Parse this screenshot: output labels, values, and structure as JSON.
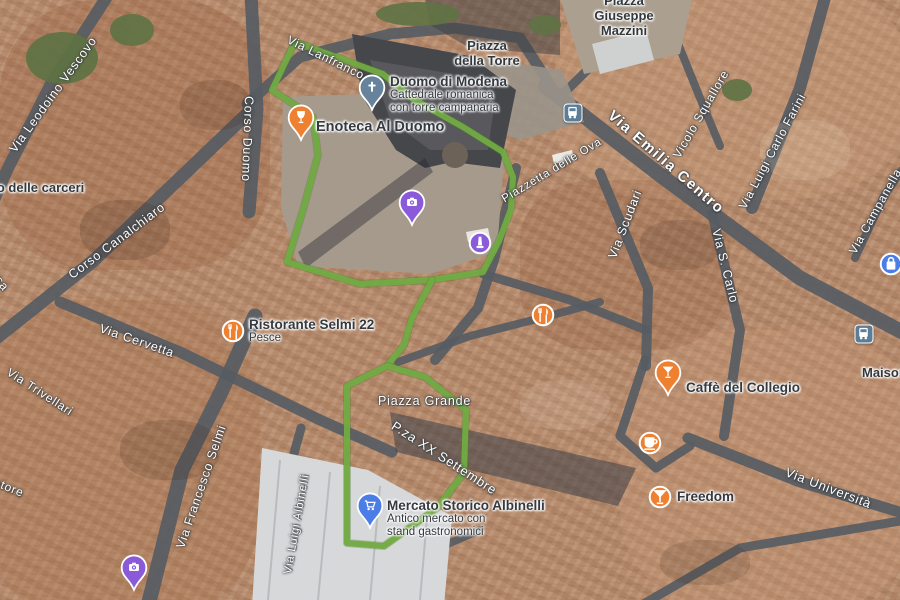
{
  "map": {
    "kind": "satellite-route-map",
    "route_color": "#72ab43",
    "poi_orange": "#ef8030",
    "poi_purple": "#8a5ad8",
    "poi_blue": "#4a7de8",
    "poi_church": "#66839b",
    "transit_color": "#5d7d96"
  },
  "route": {
    "outer_loop": "295,42 272,90 313,117 318,155 303,210 287,262 360,284 432,280 483,272 499,241 511,209 513,177 503,152 463,127 413,99 383,74 295,42",
    "connector": "432,280 412,318 404,345 387,366",
    "inner_loop": "387,366 347,386 347,543 384,546 437,508 464,473 466,410 425,377 387,366"
  },
  "pois": [
    {
      "id": "duomo-di-modena",
      "title": "Duomo di Modena",
      "subtitle_lines": [
        "Cattedrale romanica",
        "con torre campanaria"
      ],
      "marker": "pin",
      "icon": "church",
      "color": "#66839b",
      "x": 372,
      "y": 96,
      "label": {
        "x": 390,
        "y": 74,
        "align": "left",
        "size": 13.5
      }
    },
    {
      "id": "enoteca-al-duomo",
      "title": "Enoteca Al Duomo",
      "subtitle_lines": [],
      "marker": "pin",
      "icon": "wine",
      "color": "#ef8030",
      "x": 301,
      "y": 126,
      "label": {
        "x": 316,
        "y": 120,
        "align": "left",
        "size": 14.5
      }
    },
    {
      "id": "piazza-grande",
      "title": "Piazza Grande",
      "subtitle_lines": [],
      "marker": "pin",
      "icon": "camera",
      "color": "#8a5ad8",
      "x": 412,
      "y": 211,
      "label": {
        "x": 396,
        "y": 209,
        "align": "right",
        "size": 14.5
      }
    },
    {
      "id": "monument-poi",
      "title": "",
      "subtitle_lines": [],
      "marker": "dot",
      "icon": "monument",
      "color": "#8a5ad8",
      "x": 480,
      "y": 243
    },
    {
      "id": "mana",
      "title": "Manà",
      "subtitle_lines": [],
      "marker": "dot",
      "icon": "restaurant",
      "color": "#ef8030",
      "x": 543,
      "y": 315,
      "label": {
        "x": 527,
        "y": 307,
        "align": "right",
        "size": 13.5
      }
    },
    {
      "id": "ristorante-selmi-22",
      "title": "Ristorante Selmi 22",
      "subtitle_lines": [
        "Pesce"
      ],
      "marker": "dot",
      "icon": "restaurant",
      "color": "#ef8030",
      "x": 233,
      "y": 331,
      "label": {
        "x": 249,
        "y": 317,
        "align": "left",
        "size": 13.5
      }
    },
    {
      "id": "caffe-del-collegio",
      "title": "Caffè del Collegio",
      "subtitle_lines": [],
      "marker": "pin",
      "icon": "cocktail",
      "color": "#ef8030",
      "x": 668,
      "y": 381,
      "label": {
        "x": 686,
        "y": 380,
        "align": "left",
        "size": 13.5
      }
    },
    {
      "id": "canalino-caffe",
      "title": "Canalino Caffè",
      "subtitle_lines": [],
      "marker": "dot",
      "icon": "coffee",
      "color": "#ef8030",
      "x": 650,
      "y": 443,
      "label": {
        "x": 634,
        "y": 436,
        "align": "right",
        "size": 13.5
      }
    },
    {
      "id": "freedom",
      "title": "Freedom",
      "subtitle_lines": [],
      "marker": "dot",
      "icon": "cocktail",
      "color": "#ef8030",
      "x": 660,
      "y": 497,
      "label": {
        "x": 677,
        "y": 489,
        "align": "left",
        "size": 13.5
      }
    },
    {
      "id": "zara",
      "title": "Zara",
      "subtitle_lines": [
        "Negozio di abbigliamento"
      ],
      "marker": "dot",
      "icon": "bag",
      "color": "#4a7de8",
      "x": 891,
      "y": 264,
      "label": {
        "x": 877,
        "y": 249,
        "align": "right",
        "size": 14.5
      }
    },
    {
      "id": "mercato-storico-albinelli",
      "title": "Mercato Storico Albinelli",
      "subtitle_lines": [
        "Antico mercato con",
        "stand gastronomici"
      ],
      "marker": "pin",
      "icon": "cart",
      "color": "#4a7de8",
      "x": 370,
      "y": 514,
      "label": {
        "x": 387,
        "y": 498,
        "align": "left",
        "size": 13.5
      }
    },
    {
      "id": "storico-di-modena",
      "title": "Storico di Modena",
      "subtitle_lines": [],
      "marker": "pin",
      "icon": "camera",
      "color": "#8a5ad8",
      "x": 134,
      "y": 576,
      "label": {
        "x": 118,
        "y": 570,
        "align": "right",
        "size": 13.5
      }
    }
  ],
  "street_labels": [
    {
      "text": "Via Lanfranco",
      "x": 288,
      "y": 38,
      "rot": 26,
      "size": 12
    },
    {
      "text": "Via Leodoino Vescovo",
      "x": 12,
      "y": 150,
      "rot": -54,
      "size": 12.5
    },
    {
      "text": "Corso Duomo",
      "x": 249,
      "y": 95,
      "rot": 92,
      "size": 12.5
    },
    {
      "text": "corsa",
      "x": -14,
      "y": 262,
      "rot": 52,
      "size": 12
    },
    {
      "text": "Corso Canalchiaro",
      "x": 70,
      "y": 275,
      "rot": -37,
      "size": 12.5
    },
    {
      "text": "Via Cervetta",
      "x": 100,
      "y": 327,
      "rot": 19,
      "size": 12.5
    },
    {
      "text": "Via Trivellari",
      "x": 8,
      "y": 370,
      "rot": 33,
      "size": 12
    },
    {
      "text": "vatore",
      "x": -12,
      "y": 478,
      "rot": 22,
      "size": 12
    },
    {
      "text": "Via Francesco Selmi",
      "x": 180,
      "y": 547,
      "rot": -71,
      "size": 12.5
    },
    {
      "text": "Via Luigi Albinelli",
      "x": 288,
      "y": 574,
      "rot": -80,
      "size": 11.5
    },
    {
      "text": "Piazza Grande",
      "x": 378,
      "y": 400,
      "rot": 0,
      "size": 12.5
    },
    {
      "text": "P.za XX Settembre",
      "x": 393,
      "y": 423,
      "rot": 33,
      "size": 13
    },
    {
      "text": "Piazzetta delle Ova",
      "x": 503,
      "y": 200,
      "rot": -31,
      "size": 11.5
    },
    {
      "text": "Via Emilia Centro",
      "x": 610,
      "y": 112,
      "rot": 41,
      "size": 15
    },
    {
      "text": "Via Scudari",
      "x": 612,
      "y": 257,
      "rot": -69,
      "size": 12.5
    },
    {
      "text": "Vicolo Squallore",
      "x": 676,
      "y": 156,
      "rot": -60,
      "size": 12
    },
    {
      "text": "Via Luigi Carlo Farini",
      "x": 742,
      "y": 207,
      "rot": -62,
      "size": 12
    },
    {
      "text": "Via S. Carlo",
      "x": 716,
      "y": 228,
      "rot": 76,
      "size": 12.5
    },
    {
      "text": "Via Campanella",
      "x": 852,
      "y": 252,
      "rot": -61,
      "size": 12
    },
    {
      "text": "Via Università",
      "x": 786,
      "y": 470,
      "rot": 21,
      "size": 13
    }
  ],
  "place_labels": [
    {
      "id": "piazza-della-torre",
      "lines": [
        "Piazza",
        "della Torre"
      ],
      "x": 487,
      "y": 38,
      "align": "center",
      "size": 13
    },
    {
      "id": "piazza-giuseppe-mazzini",
      "lines": [
        "Piazza",
        "Giuseppe",
        "Mazzini"
      ],
      "x": 624,
      "y": -7,
      "align": "center",
      "size": 13
    },
    {
      "id": "delle-carceri",
      "lines": [
        "cio delle carceri"
      ],
      "x": -14,
      "y": 180,
      "align": "left",
      "size": 13
    },
    {
      "id": "maison",
      "lines": [
        "Maison"
      ],
      "x": 862,
      "y": 365,
      "align": "left",
      "size": 13
    }
  ],
  "transit_stops": [
    {
      "id": "transit-stop-1",
      "x": 573,
      "y": 113
    },
    {
      "id": "transit-stop-2",
      "x": 864,
      "y": 334
    }
  ]
}
